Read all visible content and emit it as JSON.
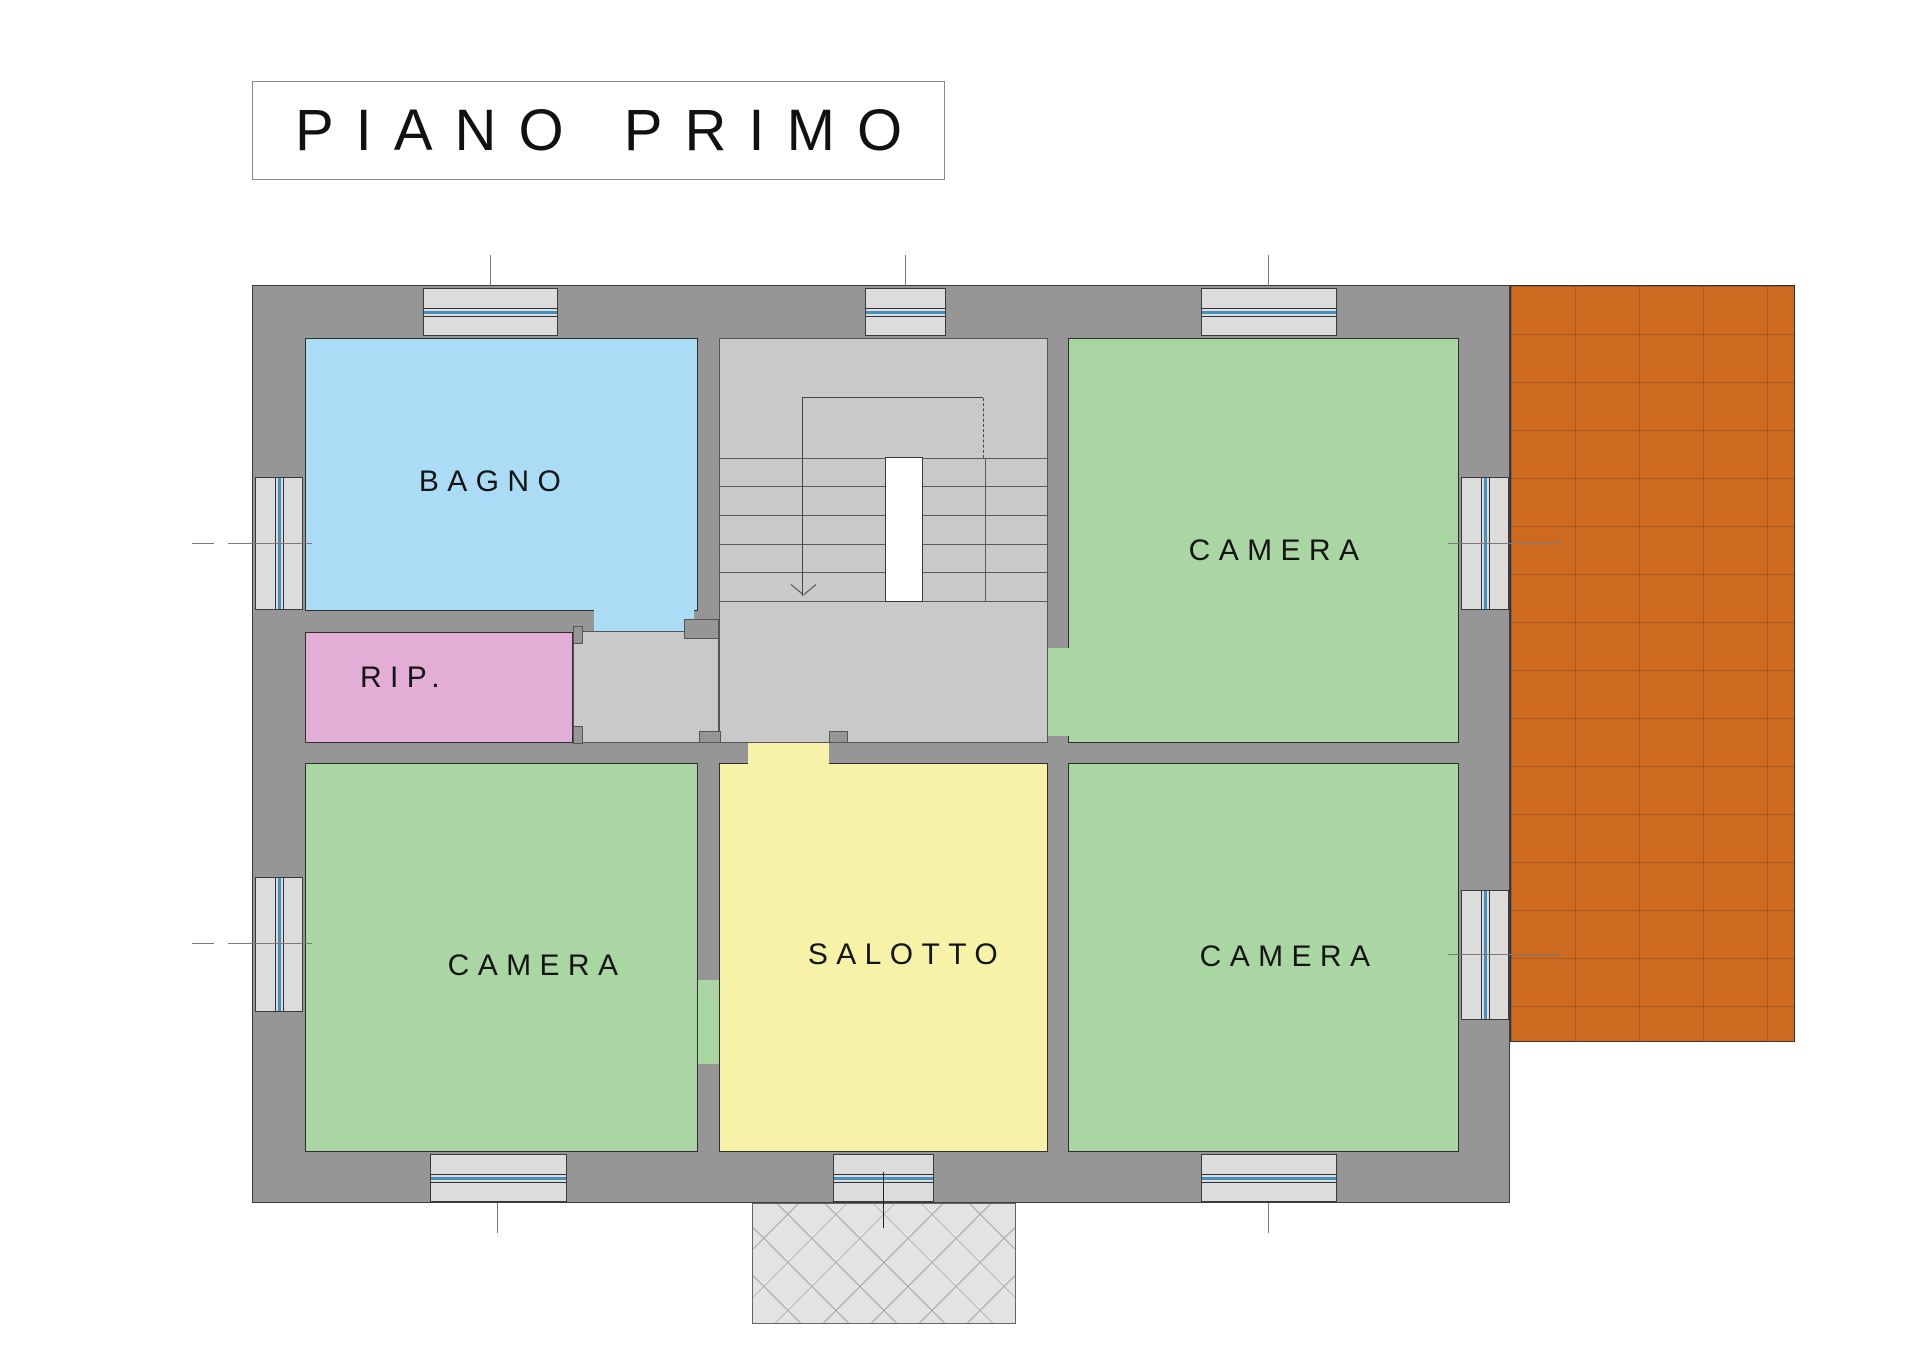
{
  "title": "PIANO PRIMO",
  "rooms": {
    "bagno": {
      "label": "BAGNO",
      "color": "#abdcf5"
    },
    "camera_ne": {
      "label": "CAMERA",
      "color": "#a9d6a2"
    },
    "rip": {
      "label": "RIP.",
      "color": "#e2aed6"
    },
    "camera_sw": {
      "label": "CAMERA",
      "color": "#a9d6a2"
    },
    "salotto": {
      "label": "SALOTTO",
      "color": "#f6f2a8"
    },
    "camera_se": {
      "label": "CAMERA",
      "color": "#a9d6a2"
    }
  },
  "palette": {
    "wall": "#969696",
    "hall_floor": "#c9c9c9",
    "window_fill": "#dcdcdc",
    "glazing_blue": "#4490c0",
    "terrace": "#ce6a20",
    "porch": "#e3e3e3",
    "outline": "#333333",
    "stair_void": "#ffffff"
  },
  "stairs": {
    "direction_icon": "down-arrow",
    "step_count": 6
  }
}
